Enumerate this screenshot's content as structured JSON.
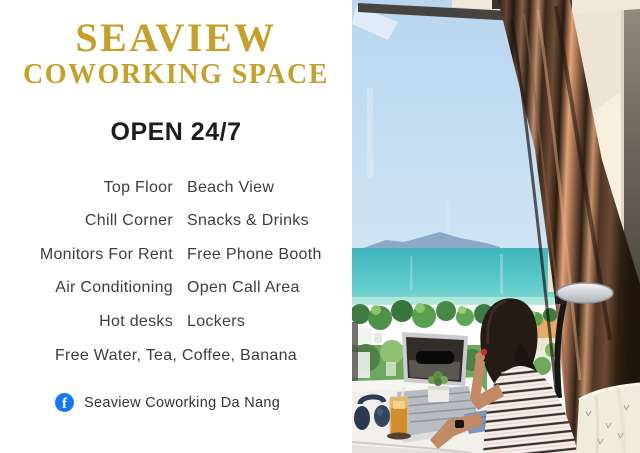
{
  "left_panel": {
    "title_line1": "SEAVIEW",
    "title_line2": "COWORKING SPACE",
    "hours": "OPEN 24/7",
    "features": [
      {
        "left": "Top Floor",
        "right": "Beach View"
      },
      {
        "left": "Chill Corner",
        "right": "Snacks & Drinks"
      },
      {
        "left": "Monitors For Rent",
        "right": "Free Phone Booth"
      },
      {
        "left": "Air Conditioning",
        "right": "Open Call Area"
      },
      {
        "left": "Hot desks",
        "right": "Lockers"
      }
    ],
    "features_footer": "Free Water, Tea, Coffee, Banana",
    "social": {
      "network": "facebook",
      "icon_letter": "f",
      "label": "Seaview Coworking Da Nang"
    }
  },
  "colors": {
    "panel_background": "#FFFFFF",
    "title_gold": "#C4A02C",
    "heading_black": "#1E1E1E",
    "body_text": "#3D3D3D",
    "facebook_blue": "#1877F2",
    "photo_sky": "#BCD8EF",
    "photo_sea": "#4FBEC4",
    "photo_sand": "#E3AC68",
    "photo_curtain_brown": "#6B4A35"
  }
}
